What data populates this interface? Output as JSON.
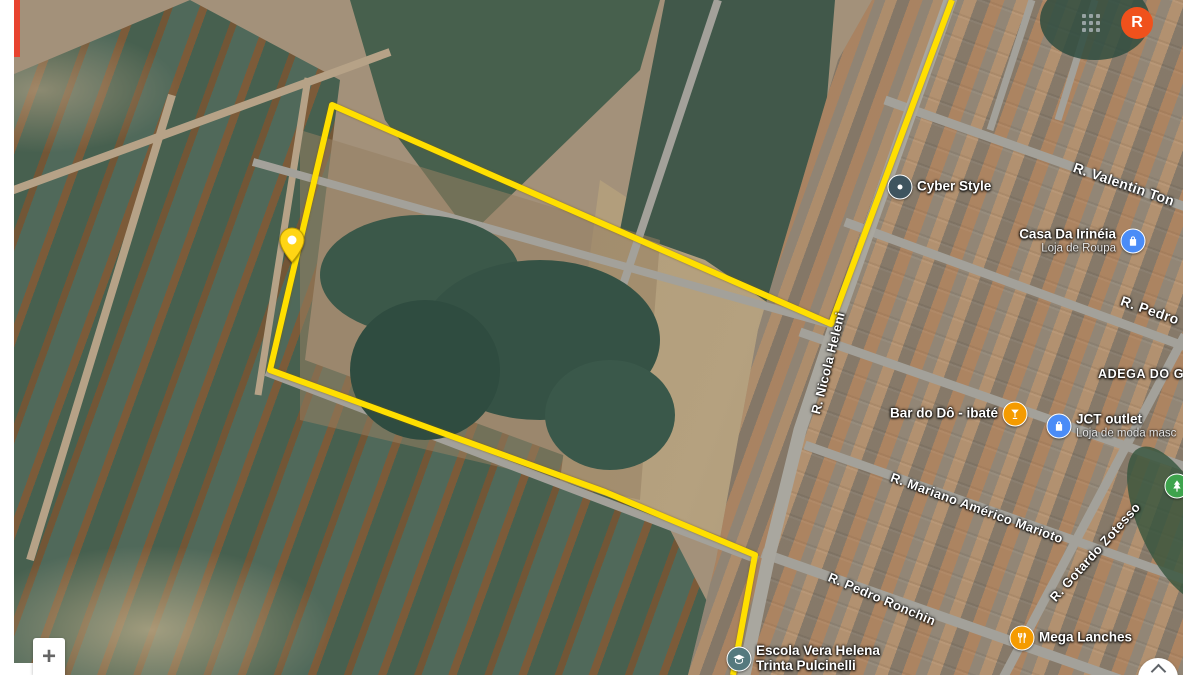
{
  "app": {
    "view": "satellite-map"
  },
  "chrome": {
    "red_edge_bar_color": "#e8432f"
  },
  "account": {
    "avatar_letter": "R",
    "avatar_color": "#f0511c"
  },
  "controls": {
    "zoom_in_label": "+",
    "collapse_icon": "chevron-up",
    "apps_grid_icon": "3x3-dots"
  },
  "map": {
    "imagery": "satellite",
    "boundary": {
      "color": "#ffdf00",
      "stroke_width": 6,
      "points": [
        [
          952,
          0
        ],
        [
          831,
          324
        ],
        [
          332,
          105
        ],
        [
          270,
          370
        ],
        [
          605,
          492
        ],
        [
          755,
          555
        ],
        [
          733,
          675
        ]
      ]
    },
    "marker": {
      "icon": "map-pin",
      "color": "#ffd514",
      "x": 292,
      "y": 262
    },
    "street_labels": [
      {
        "label": "R. Valentin Ton",
        "x": 1124,
        "y": 184,
        "angle": 19,
        "size": "big"
      },
      {
        "label": "R. Pedro",
        "x": 1150,
        "y": 310,
        "angle": 19,
        "size": "big"
      },
      {
        "label": "R. Nicola Heleni",
        "x": 828,
        "y": 363,
        "angle": -76
      },
      {
        "label": "ADEGA DO G",
        "x": 1141,
        "y": 374,
        "angle": 0,
        "kind": "area"
      },
      {
        "label": "R. Mariano Américo Marioto",
        "x": 977,
        "y": 508,
        "angle": 20
      },
      {
        "label": "R. Pedro Ronchin",
        "x": 882,
        "y": 599,
        "angle": 23
      },
      {
        "label": "R. Gotardo Zotesso",
        "x": 1095,
        "y": 552,
        "angle": -48
      }
    ],
    "pois": [
      {
        "name": "Cyber Style",
        "icon": "dot",
        "color": "#3e545f",
        "x": 900,
        "y": 187,
        "side": "right"
      },
      {
        "name": "Casa Da Irinéia",
        "subtitle": "Loja de Roupa",
        "icon": "bag",
        "color": "#4a8cf7",
        "x": 1133,
        "y": 241,
        "side": "left"
      },
      {
        "name": "Bar do Dô - ibaté",
        "icon": "cocktail",
        "color": "#f59b00",
        "x": 1015,
        "y": 414,
        "side": "left"
      },
      {
        "name": "JCT outlet",
        "subtitle": "Loja de moda masc",
        "icon": "bag",
        "color": "#4a8cf7",
        "x": 1059,
        "y": 426,
        "side": "right"
      },
      {
        "name": "Mega Lanches",
        "icon": "restaurant",
        "color": "#f59b00",
        "x": 1022,
        "y": 638,
        "side": "right"
      },
      {
        "name": "Escola Vera Helena",
        "name_line2": "Trinta Pulcinelli",
        "icon": "school",
        "color": "#55797e",
        "x": 739,
        "y": 659,
        "side": "right"
      },
      {
        "name": "",
        "icon": "park",
        "color": "#3ea34d",
        "x": 1177,
        "y": 486,
        "side": "none"
      }
    ]
  }
}
